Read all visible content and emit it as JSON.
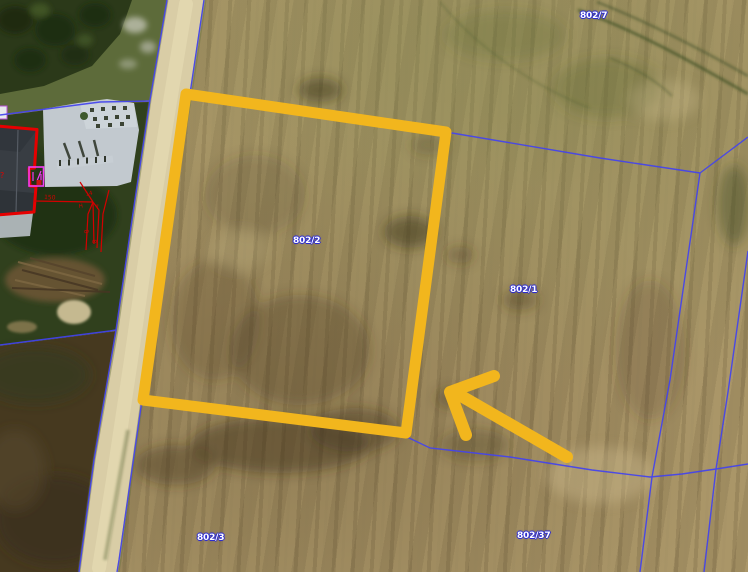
{
  "map": {
    "parcels": [
      {
        "label": "802/7"
      },
      {
        "label": "802/2"
      },
      {
        "label": "802/1"
      },
      {
        "label": "802/3"
      },
      {
        "label": "802/37"
      }
    ],
    "survey": {
      "distance": "150",
      "marks": [
        "14",
        "H",
        "7",
        "8",
        "8",
        "?"
      ]
    },
    "colors": {
      "highlight_yellow": "#F2B61D",
      "boundary_blue": "#4343EF",
      "survey_red": "#D40000",
      "building_outline_red": "#E60000",
      "annotation_magenta": "#F23CF2",
      "label_text": "#FFFFFF",
      "label_halo": "#2B2BD0"
    }
  }
}
